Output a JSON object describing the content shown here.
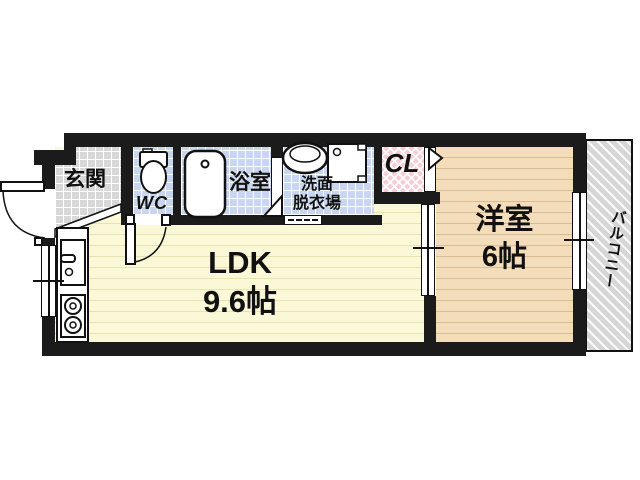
{
  "floorplan": {
    "type": "apartment-floor-plan",
    "rooms": {
      "genkan": {
        "label": "玄関"
      },
      "wc": {
        "label": "WC"
      },
      "bath": {
        "label": "浴室"
      },
      "washroom": {
        "label_line1": "洗面",
        "label_line2": "脱衣場"
      },
      "closet": {
        "label": "CL"
      },
      "western_room": {
        "label": "洋室",
        "area": "6帖"
      },
      "ldk": {
        "label": "LDK",
        "area": "9.6帖"
      },
      "balcony": {
        "label": "バルコニー"
      }
    },
    "colors": {
      "wall": "#1b1b1b",
      "ldk_floor": "#fbf8d7",
      "western_floor": "#f4ddba",
      "wet_tile": "#c8d6ef",
      "genkan_tile": "#d8d8d8",
      "closet_fill": "#f6cdd5",
      "balcony_fill": "#d6d6d6"
    }
  }
}
